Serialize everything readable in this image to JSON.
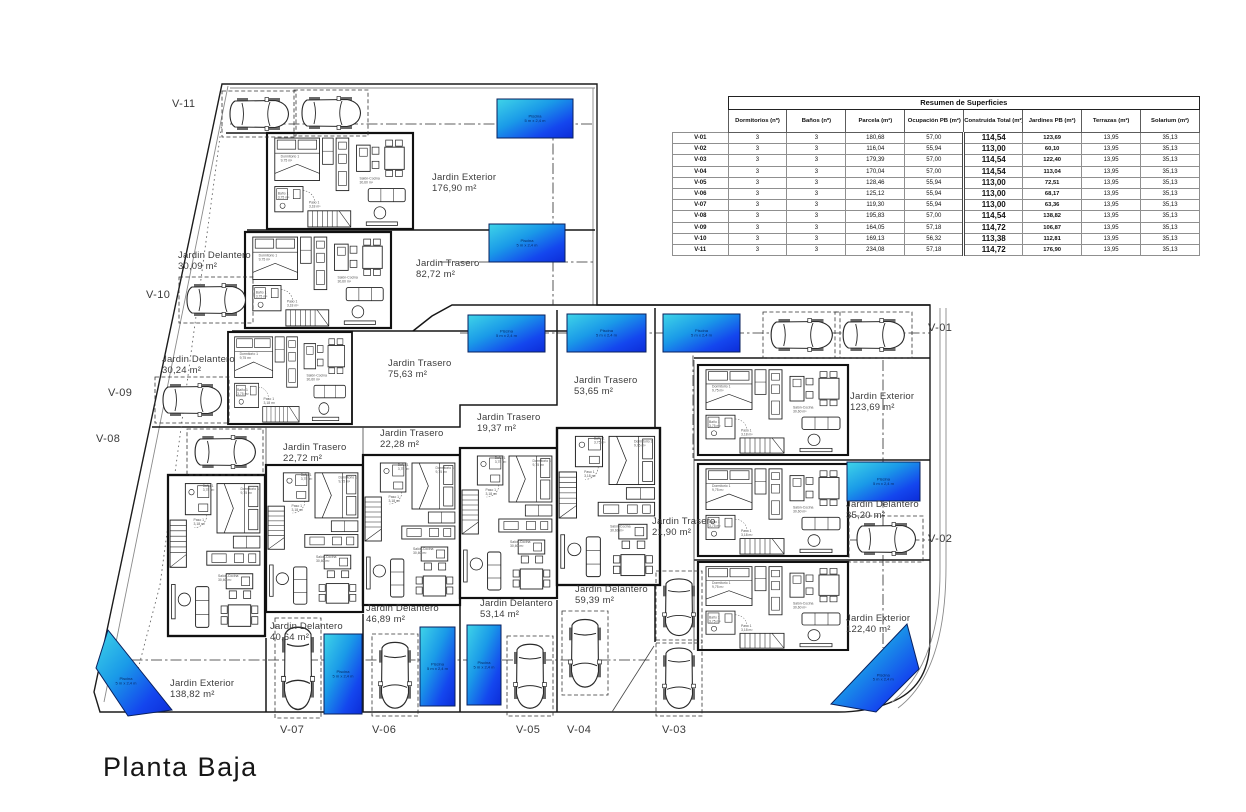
{
  "title": "Planta Baja",
  "table": {
    "title": "Resumen de Superficies",
    "columns": [
      "",
      "Dormitorios (nº)",
      "Baños (nº)",
      "Parcela (m²)",
      "Ocupación PB (m²)",
      "Construida Total (m²)",
      "Jardines PB (m²)",
      "Terrazas (m²)",
      "Solarium (m²)"
    ],
    "rows": [
      [
        "V-01",
        "3",
        "3",
        "180,68",
        "57,00",
        "114,54",
        "123,69",
        "13,95",
        "35,13"
      ],
      [
        "V-02",
        "3",
        "3",
        "116,04",
        "55,94",
        "113,00",
        "60,10",
        "13,95",
        "35,13"
      ],
      [
        "V-03",
        "3",
        "3",
        "179,39",
        "57,00",
        "114,54",
        "122,40",
        "13,95",
        "35,13"
      ],
      [
        "V-04",
        "3",
        "3",
        "170,04",
        "57,00",
        "114,54",
        "113,04",
        "13,95",
        "35,13"
      ],
      [
        "V-05",
        "3",
        "3",
        "128,46",
        "55,94",
        "113,00",
        "72,51",
        "13,95",
        "35,13"
      ],
      [
        "V-06",
        "3",
        "3",
        "125,12",
        "55,94",
        "113,00",
        "68,17",
        "13,95",
        "35,13"
      ],
      [
        "V-07",
        "3",
        "3",
        "119,30",
        "55,94",
        "113,00",
        "63,36",
        "13,95",
        "35,13"
      ],
      [
        "V-08",
        "3",
        "3",
        "195,83",
        "57,00",
        "114,54",
        "138,82",
        "13,95",
        "35,13"
      ],
      [
        "V-09",
        "3",
        "3",
        "164,05",
        "57,18",
        "114,72",
        "106,87",
        "13,95",
        "35,13"
      ],
      [
        "V-10",
        "3",
        "3",
        "169,13",
        "56,32",
        "113,38",
        "112,81",
        "13,95",
        "35,13"
      ],
      [
        "V-11",
        "3",
        "3",
        "234,08",
        "57,18",
        "114,72",
        "176,90",
        "13,95",
        "35,13"
      ]
    ]
  },
  "plan": {
    "pool_label": [
      "Piscina",
      "5 m x 2,4 m"
    ],
    "garden_labels": [
      {
        "lines": [
          "Jardin Exterior",
          "176,90 m²"
        ],
        "x": 432,
        "y": 180
      },
      {
        "lines": [
          "Jardin Delantero",
          "30,09 m²"
        ],
        "x": 178,
        "y": 258
      },
      {
        "lines": [
          "Jardin Trasero",
          "82,72 m²"
        ],
        "x": 416,
        "y": 266
      },
      {
        "lines": [
          "Jardin Delantero",
          "30,24 m²"
        ],
        "x": 162,
        "y": 362
      },
      {
        "lines": [
          "Jardin Trasero",
          "75,63 m²"
        ],
        "x": 388,
        "y": 366
      },
      {
        "lines": [
          "Jardin Trasero",
          "22,72 m²"
        ],
        "x": 283,
        "y": 450
      },
      {
        "lines": [
          "Jardin Trasero",
          "22,28 m²"
        ],
        "x": 380,
        "y": 436
      },
      {
        "lines": [
          "Jardin Trasero",
          "19,37 m²"
        ],
        "x": 477,
        "y": 420
      },
      {
        "lines": [
          "Jardin Trasero",
          "53,65 m²"
        ],
        "x": 574,
        "y": 383
      },
      {
        "lines": [
          "Jardin Trasero",
          "21,90 m²"
        ],
        "x": 652,
        "y": 524
      },
      {
        "lines": [
          "Jardin Exterior",
          "123,69 m²"
        ],
        "x": 850,
        "y": 399
      },
      {
        "lines": [
          "Jardin Delantero",
          "35,20 m²"
        ],
        "x": 846,
        "y": 507
      },
      {
        "lines": [
          "Jardin Exterior",
          "122,40 m²"
        ],
        "x": 846,
        "y": 621
      },
      {
        "lines": [
          "Jardin Exterior",
          "138,82 m²"
        ],
        "x": 170,
        "y": 686
      },
      {
        "lines": [
          "Jardin Delantero",
          "40,64 m²"
        ],
        "x": 270,
        "y": 629
      },
      {
        "lines": [
          "Jardin Delantero",
          "46,89 m²"
        ],
        "x": 366,
        "y": 611
      },
      {
        "lines": [
          "Jardin Delantero",
          "53,14 m²"
        ],
        "x": 480,
        "y": 606
      },
      {
        "lines": [
          "Jardin Delantero",
          "59,39 m²"
        ],
        "x": 575,
        "y": 592
      }
    ],
    "unit_markers": [
      {
        "id": "V-11",
        "x": 172,
        "y": 107
      },
      {
        "id": "V-10",
        "x": 146,
        "y": 298
      },
      {
        "id": "V-09",
        "x": 108,
        "y": 396
      },
      {
        "id": "V-08",
        "x": 96,
        "y": 442
      },
      {
        "id": "V-01",
        "x": 928,
        "y": 331
      },
      {
        "id": "V-02",
        "x": 928,
        "y": 542
      },
      {
        "id": "V-03",
        "x": 662,
        "y": 733
      },
      {
        "id": "V-04",
        "x": 567,
        "y": 733
      },
      {
        "id": "V-05",
        "x": 516,
        "y": 733
      },
      {
        "id": "V-06",
        "x": 372,
        "y": 733
      },
      {
        "id": "V-07",
        "x": 280,
        "y": 733
      }
    ],
    "rooms": [
      {
        "lines": [
          "Dormitorio 1",
          "9,75 m²"
        ],
        "dx": 14,
        "dy": 24
      },
      {
        "lines": [
          "Baño 1",
          "3,75 m²"
        ],
        "dx": 11,
        "dy": 61
      },
      {
        "lines": [
          "Paso 1",
          "3,18 m²"
        ],
        "dx": 43,
        "dy": 70
      },
      {
        "lines": [
          "Salón-Cocina",
          "30,60 m²"
        ],
        "dx": 95,
        "dy": 46
      }
    ],
    "units": [
      {
        "id": "unit-v11",
        "x": 267,
        "y": 133,
        "w": 146,
        "h": 96,
        "rot": 0
      },
      {
        "id": "unit-v10",
        "x": 245,
        "y": 232,
        "w": 146,
        "h": 96,
        "rot": 0
      },
      {
        "id": "unit-v09",
        "x": 228,
        "y": 332,
        "w": 124,
        "h": 92,
        "rot": 0
      },
      {
        "id": "unit-v01",
        "x": 698,
        "y": 365,
        "w": 150,
        "h": 90,
        "rot": 0
      },
      {
        "id": "unit-v02",
        "x": 698,
        "y": 464,
        "w": 150,
        "h": 92,
        "rot": 0
      },
      {
        "id": "unit-v03",
        "x": 698,
        "y": 562,
        "w": 150,
        "h": 88,
        "rot": 0
      },
      {
        "id": "unit-v08",
        "x": 168,
        "y": 475,
        "w": 97,
        "h": 161,
        "rot": 90
      },
      {
        "id": "unit-v07",
        "x": 266,
        "y": 465,
        "w": 97,
        "h": 147,
        "rot": 90
      },
      {
        "id": "unit-v06",
        "x": 363,
        "y": 455,
        "w": 97,
        "h": 150,
        "rot": 90
      },
      {
        "id": "unit-v05",
        "x": 460,
        "y": 448,
        "w": 97,
        "h": 150,
        "rot": 90
      },
      {
        "id": "unit-v04",
        "x": 557,
        "y": 428,
        "w": 103,
        "h": 157,
        "rot": 90
      }
    ],
    "cars": [
      {
        "x": 227,
        "y": 96,
        "len": 64,
        "vert": false
      },
      {
        "x": 299,
        "y": 95,
        "len": 64,
        "vert": false
      },
      {
        "x": 184,
        "y": 282,
        "len": 64,
        "vert": false
      },
      {
        "x": 160,
        "y": 382,
        "len": 64,
        "vert": false
      },
      {
        "x": 192,
        "y": 434,
        "len": 66,
        "vert": false
      },
      {
        "x": 768,
        "y": 317,
        "len": 67,
        "vert": false
      },
      {
        "x": 840,
        "y": 317,
        "len": 67,
        "vert": false
      },
      {
        "x": 854,
        "y": 521,
        "len": 64,
        "vert": false
      },
      {
        "x": 280,
        "y": 623,
        "len": 90,
        "vert": true
      },
      {
        "x": 377,
        "y": 639,
        "len": 72,
        "vert": true
      },
      {
        "x": 512,
        "y": 641,
        "len": 70,
        "vert": true
      },
      {
        "x": 567,
        "y": 616,
        "len": 74,
        "vert": true
      },
      {
        "x": 661,
        "y": 576,
        "len": 62,
        "vert": true
      },
      {
        "x": 661,
        "y": 645,
        "len": 66,
        "vert": true
      }
    ],
    "pools": [
      {
        "type": "rect",
        "x": 497,
        "y": 99,
        "w": 76,
        "h": 39
      },
      {
        "type": "rect",
        "x": 489,
        "y": 224,
        "w": 76,
        "h": 38
      },
      {
        "type": "rect",
        "x": 468,
        "y": 315,
        "w": 77,
        "h": 37
      },
      {
        "type": "rect",
        "x": 567,
        "y": 314,
        "w": 79,
        "h": 38
      },
      {
        "type": "rect",
        "x": 663,
        "y": 314,
        "w": 77,
        "h": 38
      },
      {
        "type": "rect",
        "x": 847,
        "y": 462,
        "w": 73,
        "h": 39
      },
      {
        "type": "rect",
        "x": 324,
        "y": 634,
        "w": 38,
        "h": 80
      },
      {
        "type": "rect",
        "x": 420,
        "y": 627,
        "w": 35,
        "h": 79
      },
      {
        "type": "rect",
        "x": 467,
        "y": 625,
        "w": 34,
        "h": 80
      },
      {
        "type": "poly",
        "points": "108,630 172,710 128,716 96,668"
      },
      {
        "type": "poly",
        "points": "907,624 919,669 876,712 831,704"
      }
    ],
    "colors": {
      "pool_start": "#3fd4e8",
      "pool_mid": "#1a9ae8",
      "pool_end": "#0c2cd8",
      "line": "#1c1c1c"
    }
  }
}
